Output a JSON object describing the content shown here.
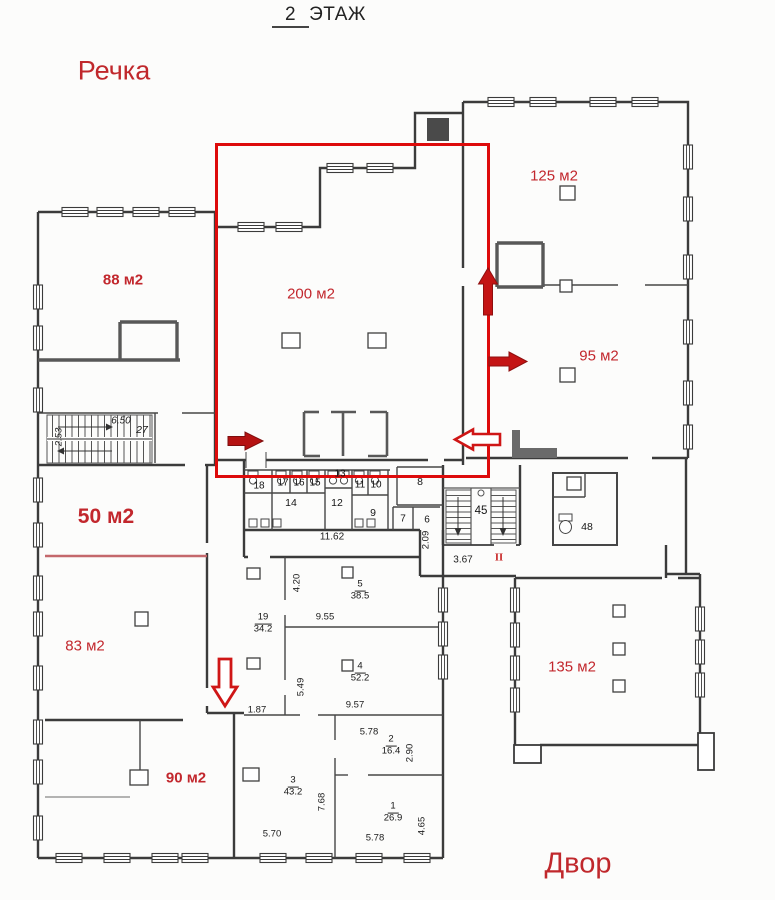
{
  "title": {
    "floor_number": "2",
    "floor_word": "ЭТАЖ"
  },
  "surroundings": {
    "top_left": "Речка",
    "bottom_right": "Двор"
  },
  "areas": {
    "a88": "88 м2",
    "a200": "200 м2",
    "a125": "125 м2",
    "a95": "95 м2",
    "a50": "50 м2",
    "a83": "83 м2",
    "a90": "90 м2",
    "a135": "135 м2"
  },
  "rooms": {
    "r27": "27",
    "r18": "18",
    "r17": "17",
    "r16": "16",
    "r15": "15",
    "r13": "13",
    "r11": "11",
    "r10": "10",
    "r14": "14",
    "r12": "12",
    "r9": "9",
    "r8": "8",
    "r7": "7",
    "r6": "6",
    "r45": "45",
    "r48": "48",
    "r19": {
      "num": "19",
      "area": "34.2"
    },
    "r5": {
      "num": "5",
      "area": "38.5"
    },
    "r4": {
      "num": "4",
      "area": "52.2"
    },
    "r3": {
      "num": "3",
      "area": "43.2"
    },
    "r2": {
      "num": "2",
      "area": "16.4"
    },
    "r1": {
      "num": "1",
      "area": "26.9"
    }
  },
  "dims": {
    "d650": "6.50",
    "d253": "2.53",
    "d1162": "11.62",
    "d209": "2.09",
    "d367": "3.67",
    "d420": "4.20",
    "d955": "9.55",
    "d549": "5.49",
    "d957": "9.57",
    "d187": "1.87",
    "d570": "5.70",
    "d768": "7.68",
    "d578a": "5.78",
    "d290": "2.90",
    "d578b": "5.78",
    "d465": "4.65"
  },
  "marks": {
    "ii": "II"
  },
  "colors": {
    "annotation_red": "#dd0b0b",
    "arrow_red": "#c41414",
    "area_label_red": "#c2272d",
    "context_label_red": "#c0282c",
    "divider_pink": "#c4686c",
    "wall_dark": "#3b3b3b"
  }
}
